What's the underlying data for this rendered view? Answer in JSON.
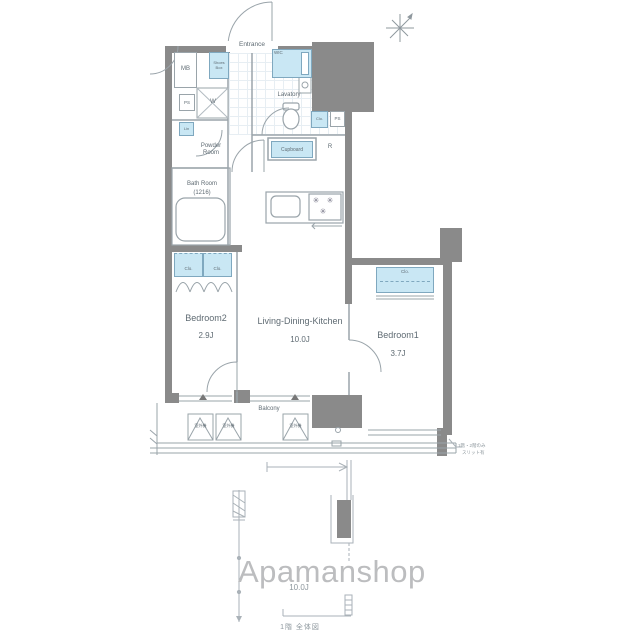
{
  "watermark": "Apamanshop",
  "rooms": {
    "entrance": "Entrance",
    "lavatory": "Lavatory",
    "powder_room": "Powder Room",
    "bath_room": "Bath Room",
    "bath_room_size": "(1216)",
    "bedroom2": "Bedroom2",
    "bedroom2_size": "2.9J",
    "ldk": "Living-Dining-Kitchen",
    "ldk_size": "10.0J",
    "bedroom1": "Bedroom1",
    "bedroom1_size": "3.7J",
    "balcony": "Balcony"
  },
  "fixtures": {
    "meter_box": "MB",
    "shoes_box": "Shoes Box",
    "walk_in_closet": "WIC",
    "pipe_space": "PS",
    "washer": "W",
    "linen": "Lin",
    "closet": "Clo.",
    "cupboard": "Cupboard",
    "refrigerator": "R",
    "outdoor_unit": "室外機"
  },
  "annotations": {
    "lower_floor_size": "10.0J",
    "footer_note": "1階 全体図",
    "side_note_line1": "1階・2階のみ",
    "side_note_line2": "スリット有"
  },
  "icons": {
    "burner_glyph": "✳"
  },
  "colors": {
    "wall": "#8a8a8a",
    "closet_fill": "#c9e7f4",
    "closet_border": "#7fa8bf",
    "label": "#5f6b73",
    "watermark": "#bcbdbf"
  }
}
